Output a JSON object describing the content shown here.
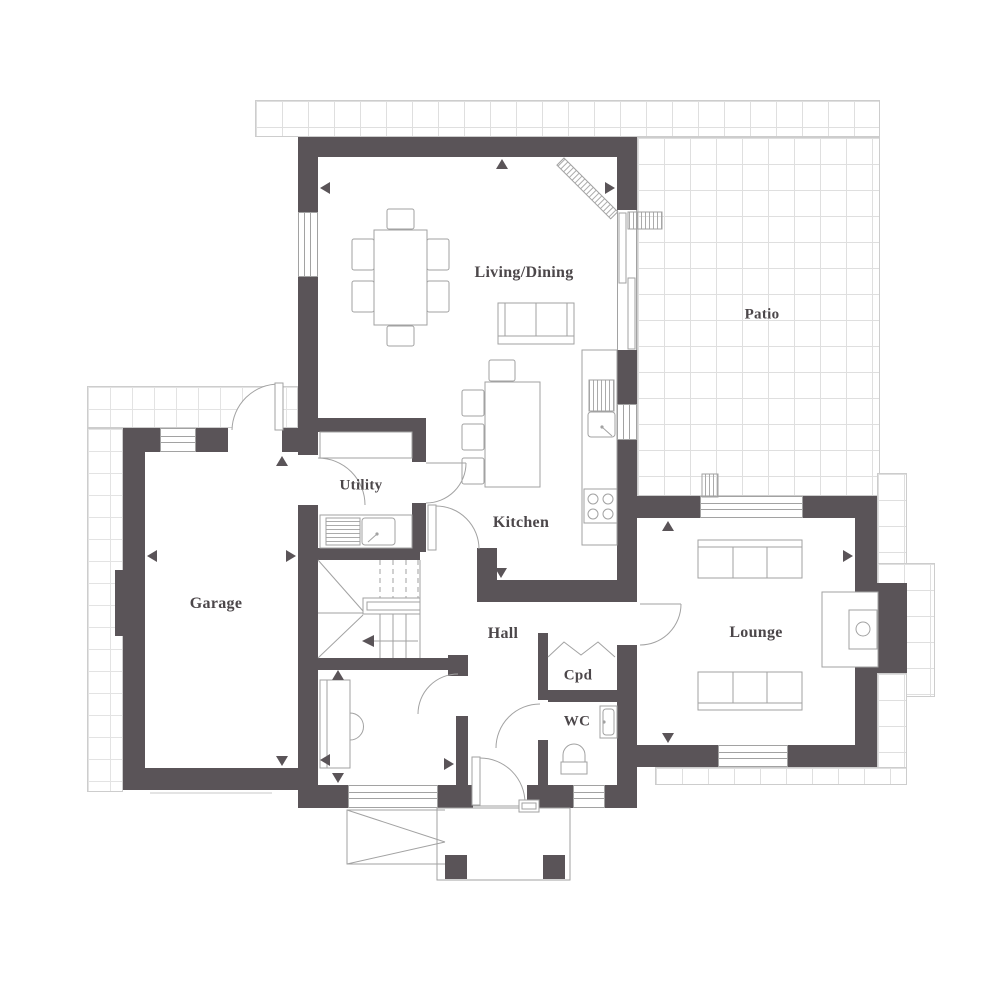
{
  "plan": {
    "type": "residential-floor-plan",
    "rooms": [
      {
        "id": "living-dining",
        "label": "Living/Dining"
      },
      {
        "id": "patio",
        "label": "Patio"
      },
      {
        "id": "utility",
        "label": "Utility"
      },
      {
        "id": "kitchen",
        "label": "Kitchen"
      },
      {
        "id": "garage",
        "label": "Garage"
      },
      {
        "id": "hall",
        "label": "Hall"
      },
      {
        "id": "lounge",
        "label": "Lounge"
      },
      {
        "id": "cupboard",
        "label": "Cpd"
      },
      {
        "id": "wc",
        "label": "WC"
      }
    ],
    "colors": {
      "wall": "#5a5458",
      "detail_line": "#a2a2a2",
      "grid_line": "#dfdfdf",
      "grid_border": "#cdcdcd",
      "label_text": "#4c474a",
      "background": "#ffffff"
    }
  }
}
